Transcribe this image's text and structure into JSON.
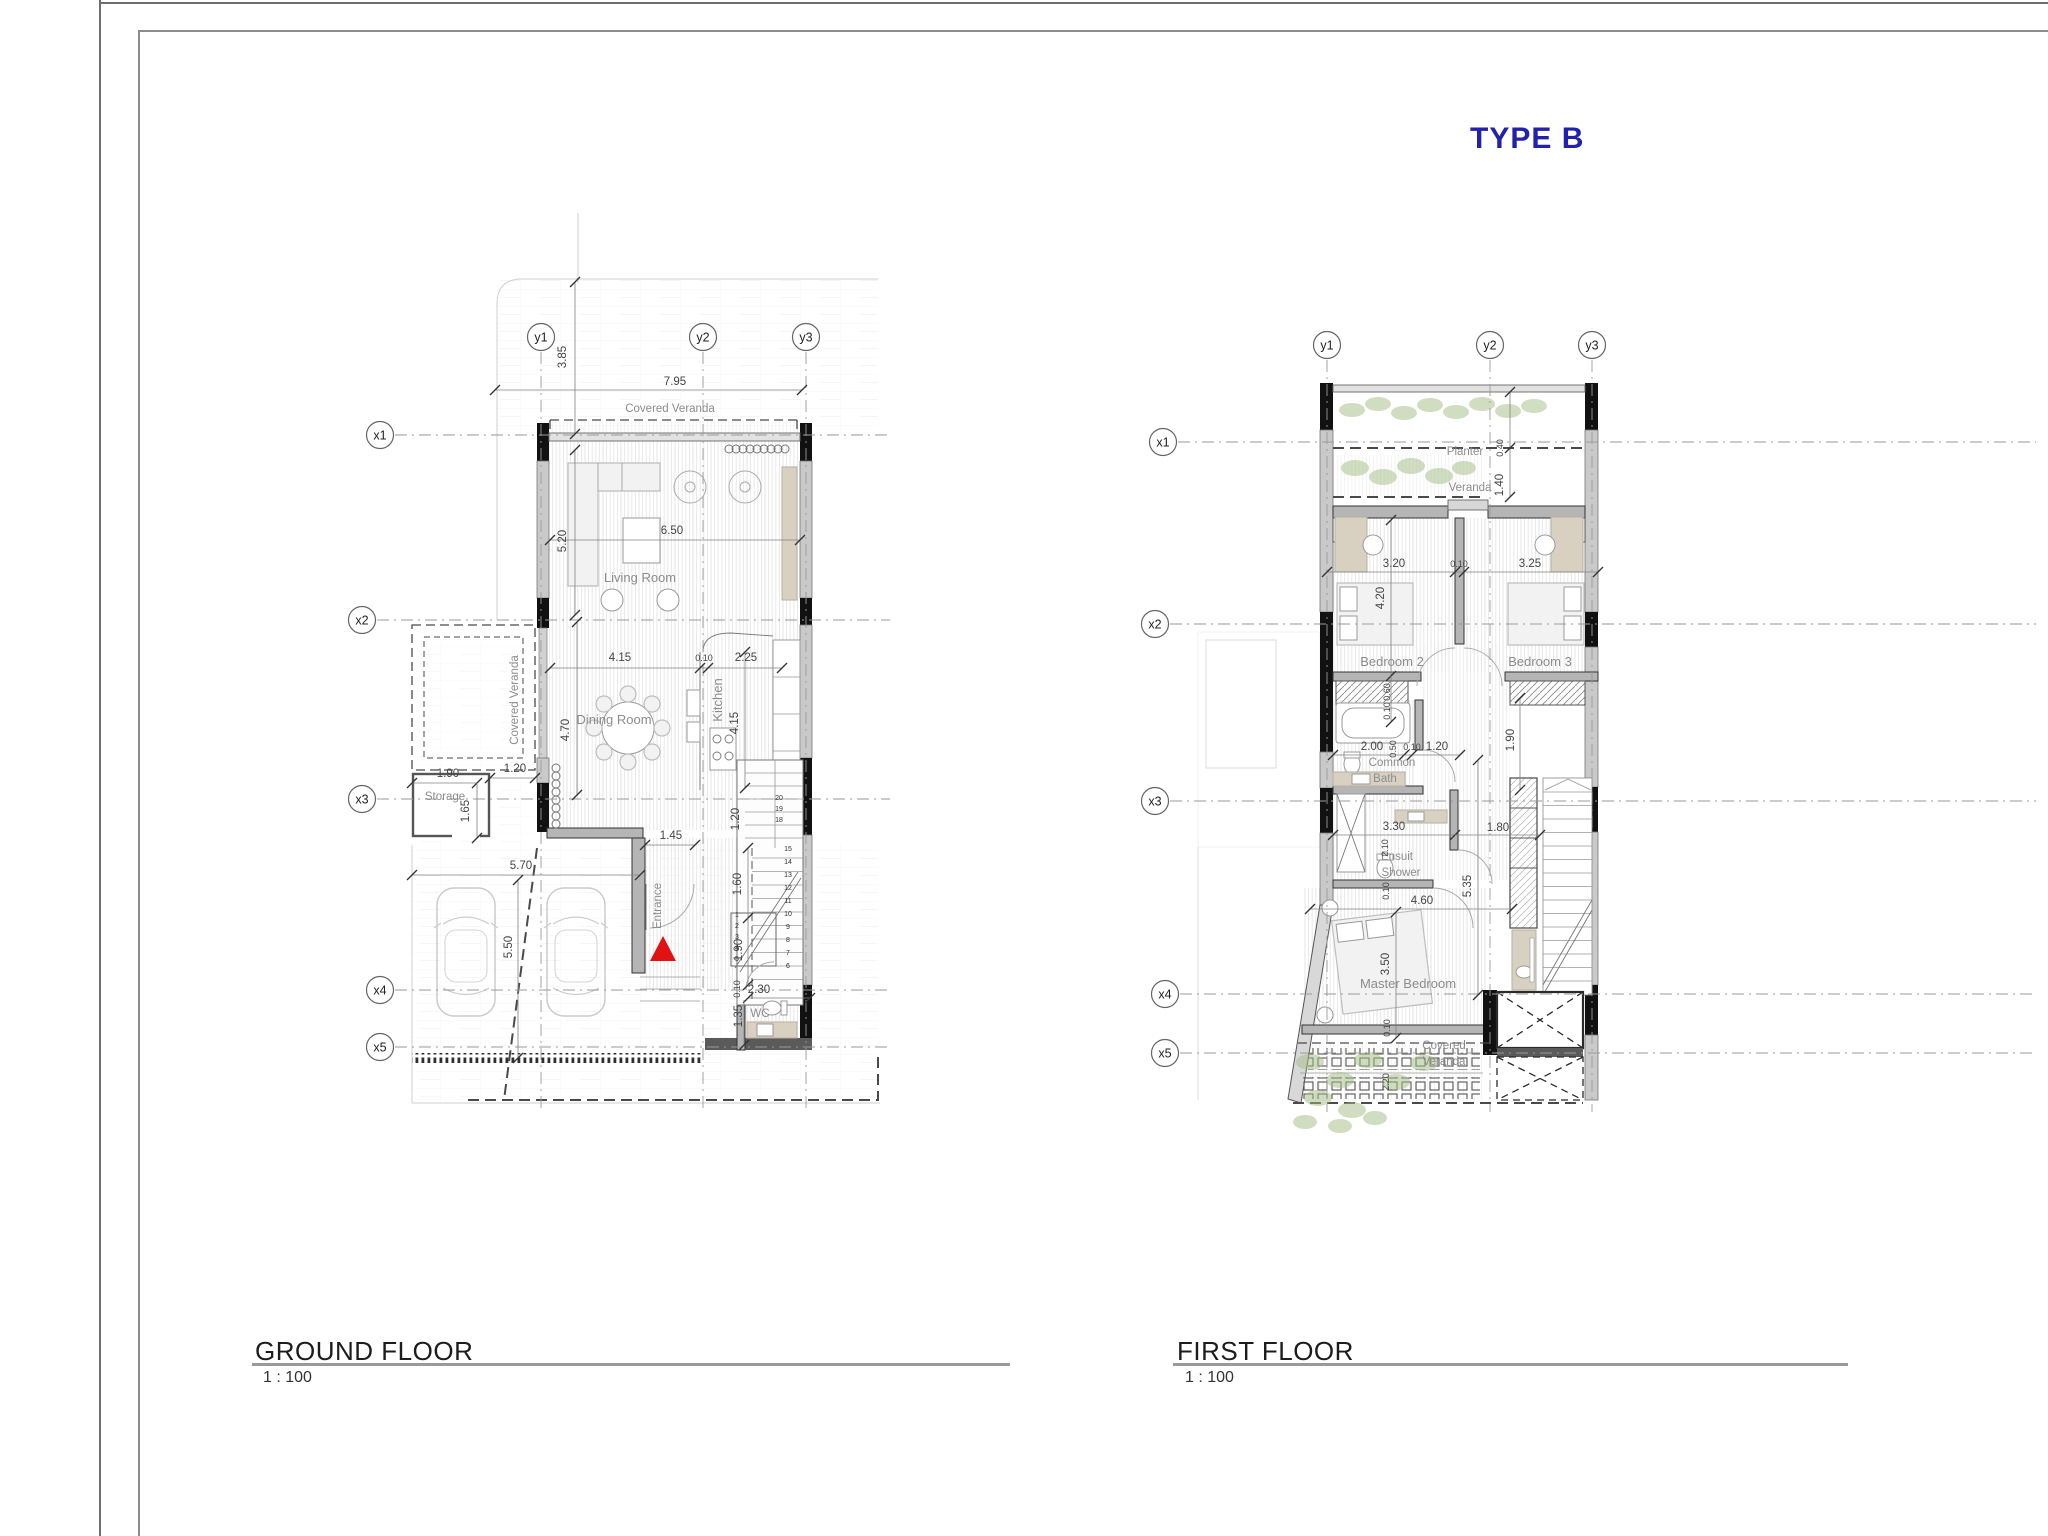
{
  "page": {
    "type_label": "TYPE B",
    "accent_blue": "#2121ad",
    "entrance_marker_color": "#e01212"
  },
  "ground_floor": {
    "title": "GROUND FLOOR",
    "scale": "1 : 100",
    "grid_markers": [
      {
        "label": "y1",
        "x": 541,
        "y": 337
      },
      {
        "label": "y2",
        "x": 703,
        "y": 337
      },
      {
        "label": "y3",
        "x": 806,
        "y": 337
      },
      {
        "label": "x1",
        "x": 380,
        "y": 435
      },
      {
        "label": "x2",
        "x": 362,
        "y": 620
      },
      {
        "label": "x3",
        "x": 362,
        "y": 799
      },
      {
        "label": "x4",
        "x": 380,
        "y": 990
      },
      {
        "label": "x5",
        "x": 380,
        "y": 1047
      }
    ],
    "room_labels": [
      {
        "t": "Covered Veranda",
        "x": 670,
        "y": 412,
        "cls": "room-sm",
        "n": "label-covered-veranda-top"
      },
      {
        "t": "Living Room",
        "x": 640,
        "y": 582,
        "cls": "room",
        "n": "label-living-room"
      },
      {
        "t": "Dining Room",
        "x": 614,
        "y": 724,
        "cls": "room",
        "n": "label-dining-room"
      },
      {
        "t": "Kitchen",
        "x": 722,
        "y": 700,
        "rot": -90,
        "cls": "room",
        "n": "label-kitchen"
      },
      {
        "t": "Storage",
        "x": 445,
        "y": 800,
        "cls": "room-sm",
        "n": "label-storage"
      },
      {
        "t": "Covered Veranda",
        "x": 518,
        "y": 700,
        "rot": -90,
        "cls": "room-sm",
        "n": "label-covered-veranda-left"
      },
      {
        "t": "Entrance",
        "x": 661,
        "y": 906,
        "rot": -90,
        "cls": "room-sm",
        "n": "label-entrance"
      },
      {
        "t": "WC",
        "x": 760,
        "y": 1017,
        "cls": "room-sm",
        "n": "label-wc"
      }
    ],
    "dimensions": [
      {
        "t": "7.95",
        "x": 675,
        "y": 385
      },
      {
        "t": "3.85",
        "x": 566,
        "y": 357,
        "rot": -90
      },
      {
        "t": "6.50",
        "x": 672,
        "y": 534
      },
      {
        "t": "5.20",
        "x": 566,
        "y": 541,
        "rot": -90
      },
      {
        "t": "4.15",
        "x": 620,
        "y": 661
      },
      {
        "t": "0.10",
        "x": 704,
        "y": 661,
        "cls": "dim-sm"
      },
      {
        "t": "2.25",
        "x": 746,
        "y": 661
      },
      {
        "t": "4.70",
        "x": 569,
        "y": 730,
        "rot": -90
      },
      {
        "t": "4.15",
        "x": 738,
        "y": 723,
        "rot": -90
      },
      {
        "t": "1.90",
        "x": 448,
        "y": 777
      },
      {
        "t": "1.65",
        "x": 469,
        "y": 811,
        "rot": -90
      },
      {
        "t": "1.20",
        "x": 515,
        "y": 772
      },
      {
        "t": "1.45",
        "x": 671,
        "y": 839
      },
      {
        "t": "5.70",
        "x": 521,
        "y": 869
      },
      {
        "t": "5.50",
        "x": 512,
        "y": 947,
        "rot": -90
      },
      {
        "t": "1.60",
        "x": 741,
        "y": 884,
        "rot": -90
      },
      {
        "t": "1.20",
        "x": 739,
        "y": 819,
        "rot": -90
      },
      {
        "t": "1.90",
        "x": 742,
        "y": 950,
        "rot": -90
      },
      {
        "t": "0.10",
        "x": 740,
        "y": 989,
        "rot": -90,
        "cls": "dim-sm"
      },
      {
        "t": "2.30",
        "x": 759,
        "y": 993
      },
      {
        "t": "1.35",
        "x": 742,
        "y": 1016,
        "rot": -90
      }
    ],
    "stair_numbers": [
      {
        "t": "20",
        "x": 779,
        "y": 800
      },
      {
        "t": "19",
        "x": 779,
        "y": 811
      },
      {
        "t": "18",
        "x": 779,
        "y": 822
      },
      {
        "t": "15",
        "x": 788,
        "y": 851
      },
      {
        "t": "14",
        "x": 788,
        "y": 864
      },
      {
        "t": "13",
        "x": 788,
        "y": 877
      },
      {
        "t": "12",
        "x": 788,
        "y": 890
      },
      {
        "t": "11",
        "x": 788,
        "y": 903
      },
      {
        "t": "10",
        "x": 788,
        "y": 916
      },
      {
        "t": "9",
        "x": 788,
        "y": 929
      },
      {
        "t": "8",
        "x": 788,
        "y": 942
      },
      {
        "t": "7",
        "x": 788,
        "y": 955
      },
      {
        "t": "6",
        "x": 788,
        "y": 968
      },
      {
        "t": "1",
        "x": 737,
        "y": 917
      },
      {
        "t": "2",
        "x": 737,
        "y": 928
      },
      {
        "t": "3",
        "x": 737,
        "y": 939
      },
      {
        "t": "4",
        "x": 737,
        "y": 950
      },
      {
        "t": "5",
        "x": 737,
        "y": 961
      }
    ]
  },
  "first_floor": {
    "title": "FIRST FLOOR",
    "scale": "1 : 100",
    "grid_markers": [
      {
        "label": "y1",
        "x": 1327,
        "y": 345
      },
      {
        "label": "y2",
        "x": 1490,
        "y": 345
      },
      {
        "label": "y3",
        "x": 1592,
        "y": 345
      },
      {
        "label": "x1",
        "x": 1163,
        "y": 442
      },
      {
        "label": "x2",
        "x": 1155,
        "y": 624
      },
      {
        "label": "x3",
        "x": 1155,
        "y": 801
      },
      {
        "label": "x4",
        "x": 1165,
        "y": 994
      },
      {
        "label": "x5",
        "x": 1165,
        "y": 1053
      }
    ],
    "room_labels": [
      {
        "t": "Planter",
        "x": 1465,
        "y": 455,
        "cls": "room-sm",
        "n": "label-planter"
      },
      {
        "t": "Veranda",
        "x": 1470,
        "y": 491,
        "cls": "room-sm",
        "n": "label-veranda"
      },
      {
        "t": "Bedroom 2",
        "x": 1392,
        "y": 666,
        "cls": "room",
        "n": "label-bedroom-2"
      },
      {
        "t": "Bedroom 3",
        "x": 1540,
        "y": 666,
        "cls": "room",
        "n": "label-bedroom-3"
      },
      {
        "t": "Common",
        "x": 1392,
        "y": 766,
        "cls": "room-sm",
        "n": "label-common-bath"
      },
      {
        "t": "Bath",
        "x": 1385,
        "y": 782,
        "cls": "room-sm",
        "n": "label-common-bath-2"
      },
      {
        "t": "Ensuit",
        "x": 1397,
        "y": 860,
        "cls": "room-sm",
        "n": "label-ensuit-shower"
      },
      {
        "t": "Shower",
        "x": 1401,
        "y": 876,
        "cls": "room-sm",
        "n": "label-ensuit-shower-2"
      },
      {
        "t": "Master Bedroom",
        "x": 1408,
        "y": 988,
        "cls": "room",
        "n": "label-master-bedroom"
      },
      {
        "t": "Covered",
        "x": 1444,
        "y": 1049,
        "cls": "room-sm",
        "n": "label-covered-veranda-ff"
      },
      {
        "t": "Veranda",
        "x": 1444,
        "y": 1065,
        "cls": "room-sm",
        "n": "label-covered-veranda-ff-2"
      }
    ],
    "dimensions": [
      {
        "t": "0.40",
        "x": 1503,
        "y": 448,
        "rot": -90,
        "cls": "dim-sm"
      },
      {
        "t": "1.40",
        "x": 1503,
        "y": 485,
        "rot": -90
      },
      {
        "t": "3.20",
        "x": 1394,
        "y": 567
      },
      {
        "t": "0.10",
        "x": 1459,
        "y": 567,
        "cls": "dim-sm"
      },
      {
        "t": "3.25",
        "x": 1530,
        "y": 567
      },
      {
        "t": "4.20",
        "x": 1384,
        "y": 598,
        "rot": -90
      },
      {
        "t": "0.60",
        "x": 1390,
        "y": 692,
        "rot": -90,
        "cls": "dim-sm"
      },
      {
        "t": "0.10",
        "x": 1390,
        "y": 711,
        "rot": -90,
        "cls": "dim-sm"
      },
      {
        "t": "2.00",
        "x": 1372,
        "y": 750
      },
      {
        "t": "0.50",
        "x": 1396,
        "y": 749,
        "rot": -90,
        "cls": "dim-sm"
      },
      {
        "t": "0.10",
        "x": 1412,
        "y": 750,
        "cls": "dim-sm"
      },
      {
        "t": "1.20",
        "x": 1437,
        "y": 750
      },
      {
        "t": "1.90",
        "x": 1514,
        "y": 740,
        "rot": -90
      },
      {
        "t": "3.30",
        "x": 1394,
        "y": 830
      },
      {
        "t": "1.80",
        "x": 1498,
        "y": 831
      },
      {
        "t": "2.10",
        "x": 1388,
        "y": 848,
        "rot": -90,
        "cls": "dim-sm"
      },
      {
        "t": "0.10",
        "x": 1389,
        "y": 891,
        "rot": -90,
        "cls": "dim-sm"
      },
      {
        "t": "5.35",
        "x": 1471,
        "y": 886,
        "rot": -90
      },
      {
        "t": "4.60",
        "x": 1422,
        "y": 904
      },
      {
        "t": "3.50",
        "x": 1389,
        "y": 964,
        "rot": -90
      },
      {
        "t": "0.10",
        "x": 1390,
        "y": 1028,
        "rot": -90,
        "cls": "dim-sm"
      },
      {
        "t": "2.20",
        "x": 1389,
        "y": 1082,
        "rot": -90,
        "cls": "dim-sm"
      }
    ]
  }
}
